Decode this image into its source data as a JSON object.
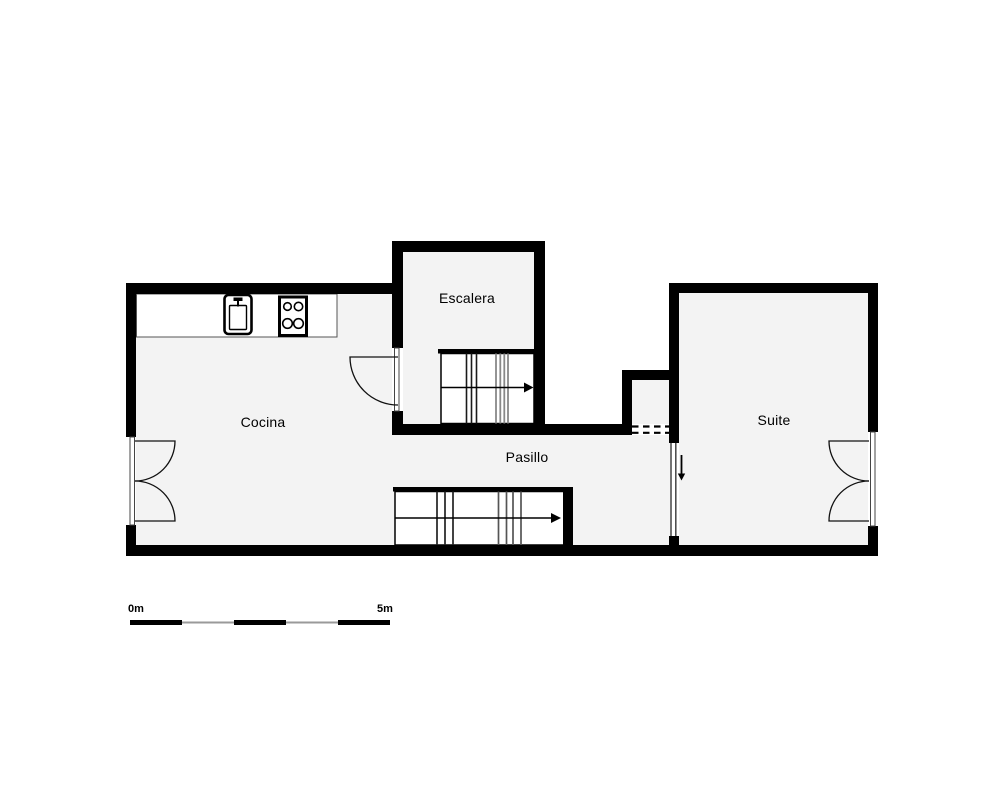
{
  "rooms": {
    "cocina": {
      "label": "Cocina"
    },
    "escalera": {
      "label": "Escalera"
    },
    "pasillo": {
      "label": "Pasillo"
    },
    "suite": {
      "label": "Suite"
    }
  },
  "scale_bar": {
    "start_label": "0m",
    "end_label": "5m",
    "segments": 5
  },
  "colors": {
    "wall": "#000000",
    "room_fill": "#f3f3f3",
    "counter_fill": "#ffffff",
    "stair_gray": "#888888",
    "scale_gray": "#9a9a9a"
  },
  "icons": {
    "sink": "sink-icon",
    "stove": "stove-icon",
    "upper_stairs_direction": "stairs-arrow-right-icon",
    "lower_stairs_direction": "stairs-arrow-right-icon",
    "suite_entry_direction": "down-arrow-icon"
  }
}
